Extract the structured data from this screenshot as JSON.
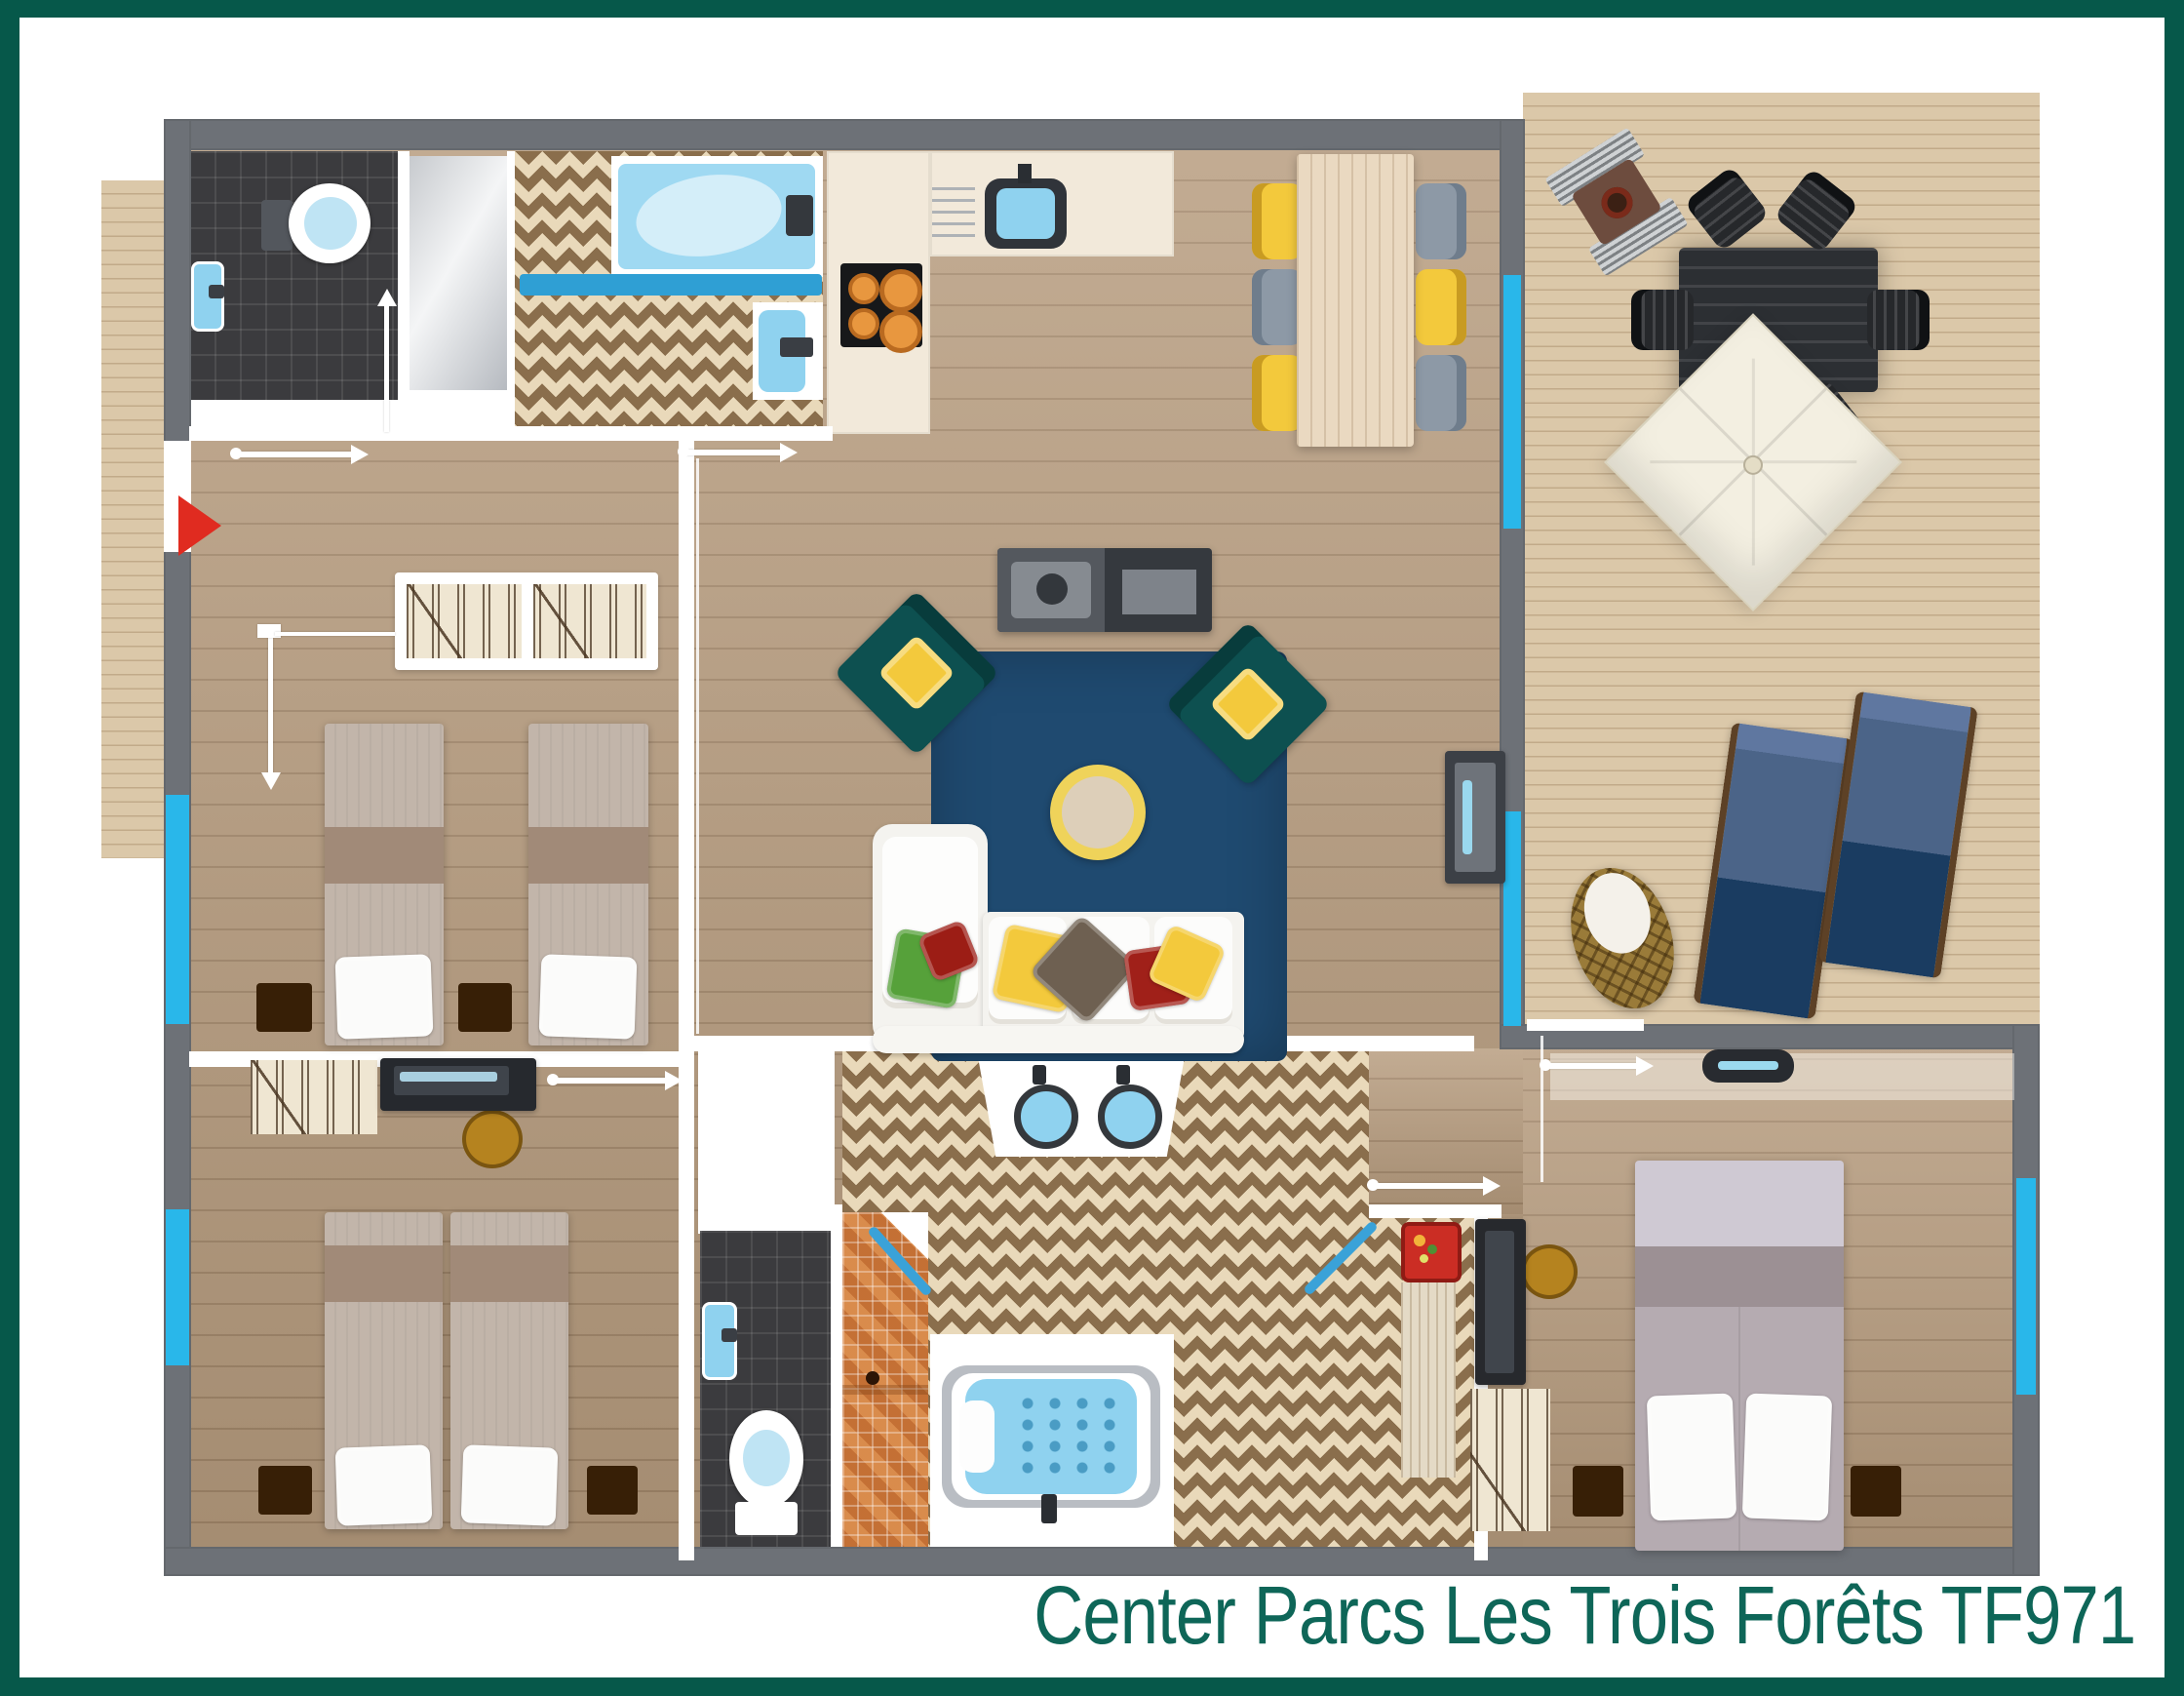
{
  "title": {
    "text": "Center Parcs Les Trois Forêts TF971"
  },
  "palette": {
    "frame": "#06584a",
    "caption": "#0e6658",
    "wall": "#6d7177",
    "partition": "#ffffff",
    "window": "#29b7ea",
    "wood": "#b79c7e",
    "deck": "#dbc8a9",
    "rug": "#1f4a70",
    "armchair": "#0d5050",
    "accent-yellow": "#f3c93c",
    "accent-red": "#e02b20",
    "water": "#8fd2ef",
    "tile": "#3b3b3e",
    "mosaic": "#d07b3e",
    "herringbone": "#8a6e4c",
    "counter": "#f2e9da",
    "sofa": "#f4f3ef",
    "lounger": "#1a3c61",
    "umbrella": "#f3efe1",
    "outdoor-furniture": "#26282b",
    "bed-linen": "#c2b5aa",
    "nightstand": "#371f06"
  },
  "rooms": [
    "entrance",
    "wc",
    "shower-room",
    "bathroom",
    "kitchen",
    "dining-area",
    "living-room",
    "bedroom-1",
    "bedroom-2",
    "bedroom-3",
    "family-bathroom",
    "terrace"
  ],
  "items": [
    "toilet",
    "washbasin",
    "bathtub",
    "towel-rail",
    "kitchen-sink",
    "stove",
    "cooker-hood-vent",
    "dining-table",
    "dining-chairs",
    "tv-console",
    "sideboard",
    "corner-sofa",
    "armchairs",
    "coffee-table",
    "area-rug",
    "wardrobe",
    "single-beds",
    "double-bed",
    "nightstands",
    "desk",
    "stool",
    "spa-bathtub",
    "double-washbasin",
    "walk-in-shower",
    "bbq-grill",
    "outdoor-table",
    "outdoor-chairs",
    "parasol",
    "sun-loungers",
    "hanging-chair",
    "entrance-arrow",
    "dimension-lines"
  ]
}
